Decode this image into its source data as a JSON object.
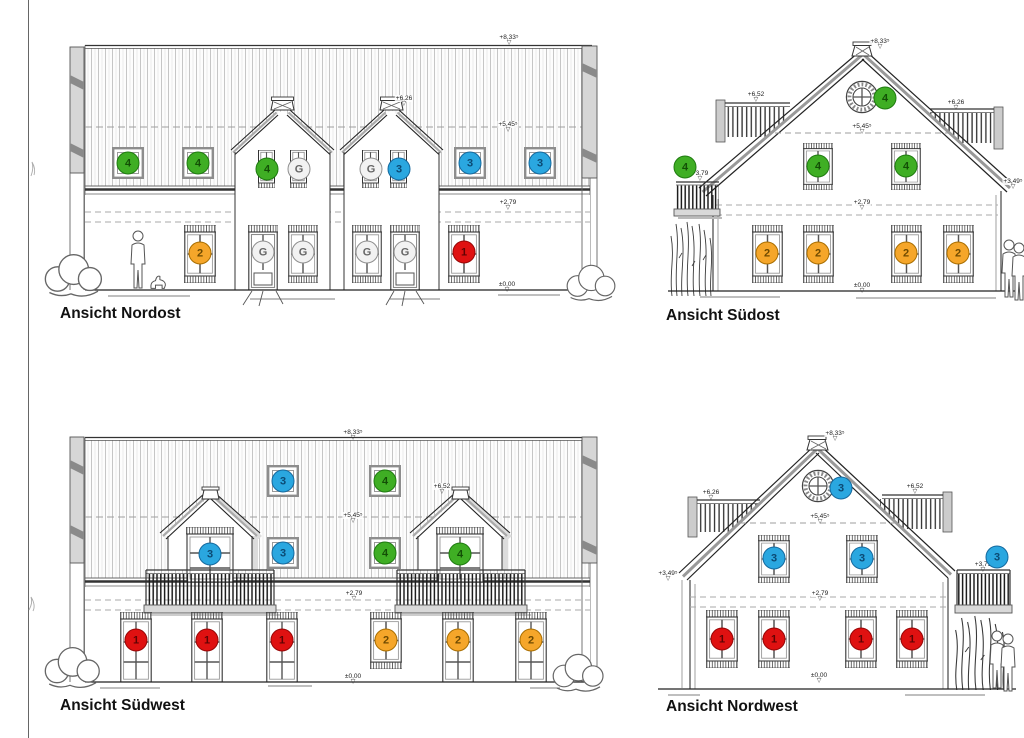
{
  "marker_glyph": "▽",
  "colors": {
    "unit_green": {
      "fill": "#3fae24",
      "border": "#1f7b10",
      "text": "#134f06"
    },
    "unit_blue": {
      "fill": "#2aa7e0",
      "border": "#15699e",
      "text": "#0b4a74"
    },
    "unit_orange": {
      "fill": "#f5a62a",
      "border": "#a96e00",
      "text": "#6e4a00"
    },
    "unit_red": {
      "fill": "#df1111",
      "border": "#970707",
      "text": "#5f0303"
    },
    "unit_grey": {
      "fill": "#f2f2f2",
      "border": "#8f8f8f",
      "text": "#666666"
    },
    "line": "#333333",
    "shading": "#d6d6d6"
  },
  "views": [
    {
      "id": "nordost",
      "title": "Ansicht Nordost",
      "dimension_markers": [
        {
          "label": "+8,33⁵",
          "x": 509,
          "y": 34
        },
        {
          "label": "+6,26",
          "x": 404,
          "y": 95
        },
        {
          "label": "+5,45⁵",
          "x": 508,
          "y": 121
        },
        {
          "label": "+2,79",
          "x": 508,
          "y": 199
        },
        {
          "label": "±0,00",
          "x": 507,
          "y": 281
        }
      ],
      "unit_markers": [
        {
          "color": "green",
          "label": "4",
          "x": 128,
          "y": 163
        },
        {
          "color": "green",
          "label": "4",
          "x": 198,
          "y": 163
        },
        {
          "color": "green",
          "label": "4",
          "x": 267,
          "y": 169
        },
        {
          "color": "grey",
          "label": "G",
          "x": 299,
          "y": 169
        },
        {
          "color": "grey",
          "label": "G",
          "x": 371,
          "y": 169
        },
        {
          "color": "blue",
          "label": "3",
          "x": 399,
          "y": 169
        },
        {
          "color": "blue",
          "label": "3",
          "x": 470,
          "y": 163
        },
        {
          "color": "blue",
          "label": "3",
          "x": 540,
          "y": 163
        },
        {
          "color": "orange",
          "label": "2",
          "x": 200,
          "y": 253
        },
        {
          "color": "grey",
          "label": "G",
          "x": 263,
          "y": 252
        },
        {
          "color": "grey",
          "label": "G",
          "x": 303,
          "y": 252
        },
        {
          "color": "grey",
          "label": "G",
          "x": 367,
          "y": 252
        },
        {
          "color": "grey",
          "label": "G",
          "x": 405,
          "y": 252
        },
        {
          "color": "red",
          "label": "1",
          "x": 464,
          "y": 252
        }
      ]
    },
    {
      "id": "suedost",
      "title": "Ansicht Südost",
      "dimension_markers": [
        {
          "label": "+8,33⁵",
          "x": 880,
          "y": 38
        },
        {
          "label": "+6,52",
          "x": 756,
          "y": 91
        },
        {
          "label": "+6,26",
          "x": 956,
          "y": 99
        },
        {
          "label": "+5,45⁵",
          "x": 862,
          "y": 123
        },
        {
          "label": "+3,79",
          "x": 700,
          "y": 170
        },
        {
          "label": "+3,49⁵",
          "x": 1013,
          "y": 178
        },
        {
          "label": "+2,79",
          "x": 862,
          "y": 199
        },
        {
          "label": "±0,00",
          "x": 862,
          "y": 282
        }
      ],
      "unit_markers": [
        {
          "color": "green",
          "label": "4",
          "x": 885,
          "y": 98
        },
        {
          "color": "green",
          "label": "4",
          "x": 818,
          "y": 166
        },
        {
          "color": "green",
          "label": "4",
          "x": 906,
          "y": 166
        },
        {
          "color": "green",
          "label": "4",
          "x": 685,
          "y": 167
        },
        {
          "color": "orange",
          "label": "2",
          "x": 767,
          "y": 253
        },
        {
          "color": "orange",
          "label": "2",
          "x": 818,
          "y": 253
        },
        {
          "color": "orange",
          "label": "2",
          "x": 906,
          "y": 253
        },
        {
          "color": "orange",
          "label": "2",
          "x": 958,
          "y": 253
        }
      ]
    },
    {
      "id": "suedwest",
      "title": "Ansicht Südwest",
      "dimension_markers": [
        {
          "label": "+8,33⁵",
          "x": 353,
          "y": 429
        },
        {
          "label": "+6,52",
          "x": 442,
          "y": 483
        },
        {
          "label": "+5,45⁵",
          "x": 353,
          "y": 512
        },
        {
          "label": "+2,79",
          "x": 354,
          "y": 590
        },
        {
          "label": "±0,00",
          "x": 353,
          "y": 673
        }
      ],
      "unit_markers": [
        {
          "color": "blue",
          "label": "3",
          "x": 283,
          "y": 481
        },
        {
          "color": "blue",
          "label": "3",
          "x": 283,
          "y": 553
        },
        {
          "color": "blue",
          "label": "3",
          "x": 210,
          "y": 554
        },
        {
          "color": "green",
          "label": "4",
          "x": 385,
          "y": 481
        },
        {
          "color": "green",
          "label": "4",
          "x": 385,
          "y": 553
        },
        {
          "color": "green",
          "label": "4",
          "x": 460,
          "y": 554
        },
        {
          "color": "red",
          "label": "1",
          "x": 136,
          "y": 640
        },
        {
          "color": "red",
          "label": "1",
          "x": 207,
          "y": 640
        },
        {
          "color": "red",
          "label": "1",
          "x": 282,
          "y": 640
        },
        {
          "color": "orange",
          "label": "2",
          "x": 386,
          "y": 640
        },
        {
          "color": "orange",
          "label": "2",
          "x": 458,
          "y": 640
        },
        {
          "color": "orange",
          "label": "2",
          "x": 531,
          "y": 640
        }
      ]
    },
    {
      "id": "nordwest",
      "title": "Ansicht Nordwest",
      "dimension_markers": [
        {
          "label": "+8,33⁵",
          "x": 835,
          "y": 430
        },
        {
          "label": "+6,26",
          "x": 711,
          "y": 489
        },
        {
          "label": "+6,52",
          "x": 915,
          "y": 483
        },
        {
          "label": "+5,45⁵",
          "x": 820,
          "y": 513
        },
        {
          "label": "+3,49⁵",
          "x": 668,
          "y": 570
        },
        {
          "label": "+3,79",
          "x": 983,
          "y": 561
        },
        {
          "label": "+2,79",
          "x": 820,
          "y": 590
        },
        {
          "label": "±0,00",
          "x": 819,
          "y": 672
        }
      ],
      "unit_markers": [
        {
          "color": "blue",
          "label": "3",
          "x": 841,
          "y": 488
        },
        {
          "color": "blue",
          "label": "3",
          "x": 774,
          "y": 558
        },
        {
          "color": "blue",
          "label": "3",
          "x": 862,
          "y": 558
        },
        {
          "color": "blue",
          "label": "3",
          "x": 997,
          "y": 557
        },
        {
          "color": "red",
          "label": "1",
          "x": 722,
          "y": 639
        },
        {
          "color": "red",
          "label": "1",
          "x": 774,
          "y": 639
        },
        {
          "color": "red",
          "label": "1",
          "x": 861,
          "y": 639
        },
        {
          "color": "red",
          "label": "1",
          "x": 912,
          "y": 639
        }
      ]
    }
  ]
}
